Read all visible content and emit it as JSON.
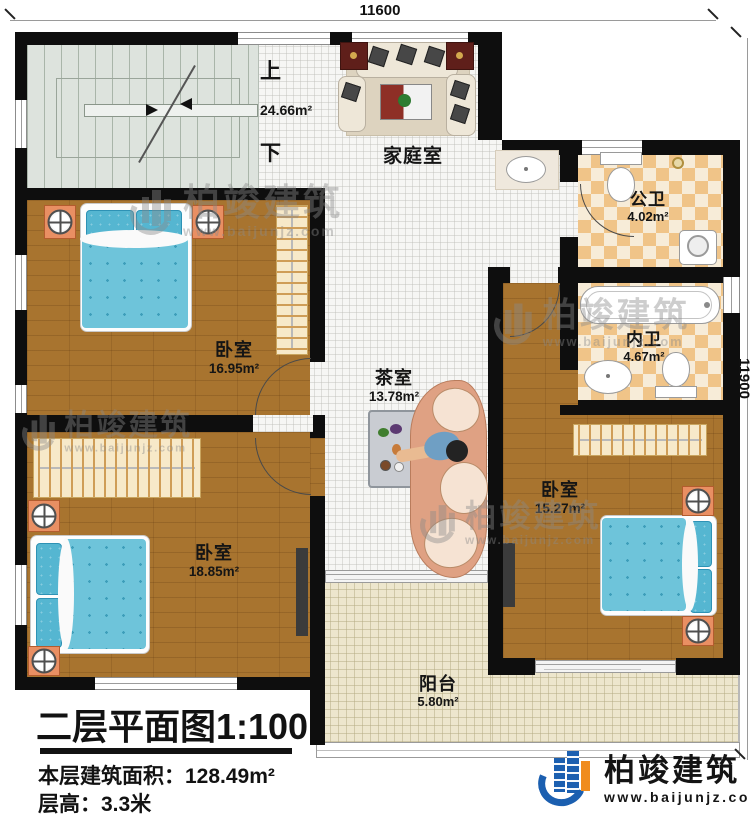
{
  "dimensions": {
    "width": "11600",
    "height": "11900"
  },
  "stairs": {
    "up": "上",
    "down": "下"
  },
  "rooms": {
    "family": {
      "name": "家庭室",
      "area": "24.66m²"
    },
    "public_bath": {
      "name": "公卫",
      "area": "4.02m²"
    },
    "inner_bath": {
      "name": "内卫",
      "area": "4.67m²"
    },
    "bedroom_top": {
      "name": "卧室",
      "area": "16.95m²"
    },
    "tea_room": {
      "name": "茶室",
      "area": "13.78m²"
    },
    "bedroom_right": {
      "name": "卧室",
      "area": "15.27m²"
    },
    "bedroom_bottom": {
      "name": "卧室",
      "area": "18.85m²"
    },
    "balcony": {
      "name": "阳台",
      "area": "5.80m²"
    }
  },
  "title_block": {
    "title": "二层平面图1:100",
    "floor_area_label": "本层建筑面积：",
    "floor_area_value": "128.49m²",
    "floor_height_label": "层高：",
    "floor_height_value": "3.3米"
  },
  "brand": {
    "name": "柏竣建筑",
    "website": "www.baijunjz.com"
  },
  "colors": {
    "wall": "#0e0e0e",
    "wood_floor": "#a8742f",
    "bath_checker": "#f0c488",
    "bed_blue": "#6ec4da",
    "logo_blue": "#1b5fb0",
    "logo_orange": "#f08c1e"
  }
}
